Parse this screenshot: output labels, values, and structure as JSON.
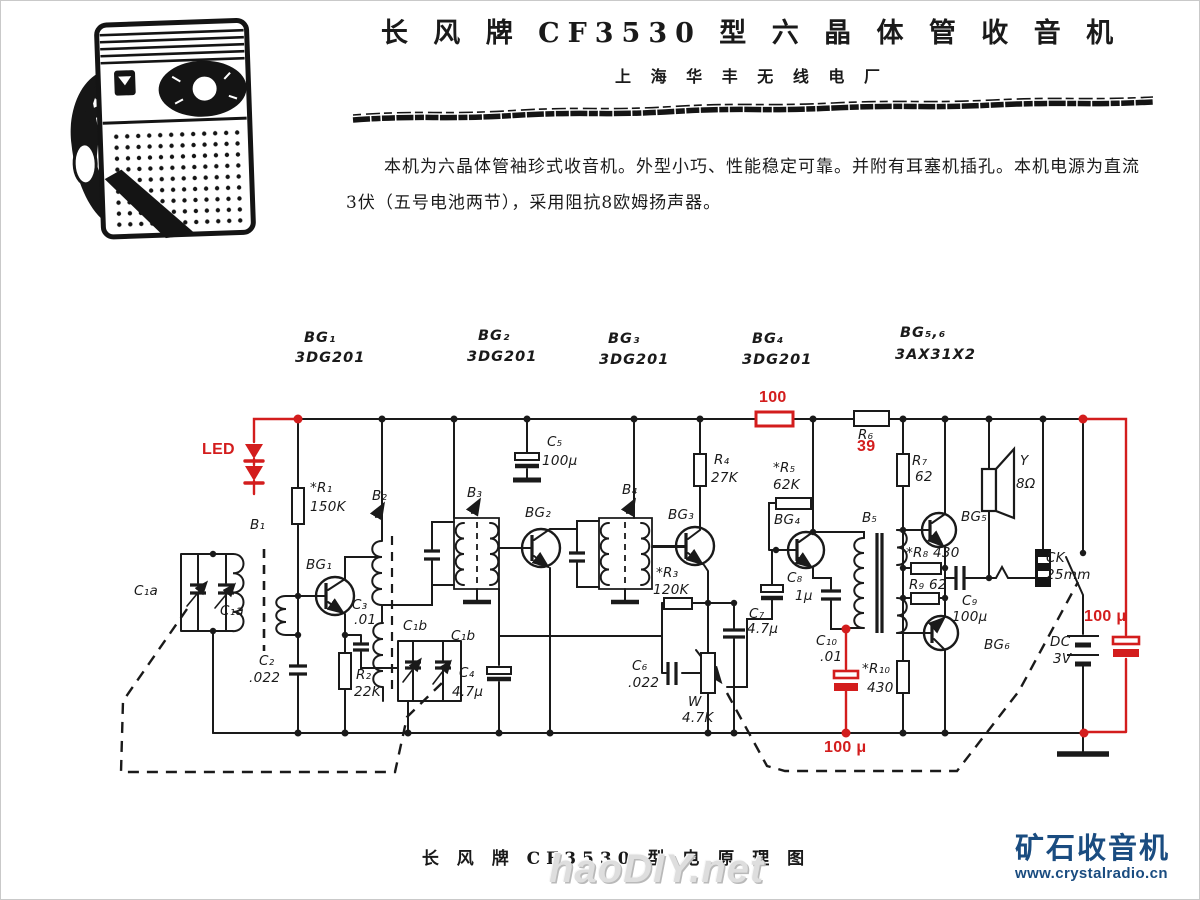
{
  "page": {
    "title": "长 风 牌 CF3530 型 六 晶 体 管 收 音 机",
    "subtitle": "上 海 华 丰 无 线 电 厂",
    "intro_line1": "本机为六晶体管袖珍式收音机。外型小巧、性能稳定可靠。并附有耳塞机插孔。本机电源为直流",
    "intro_line2": "3伏（五号电池两节），采用阻抗8欧姆扬声器。",
    "caption": "长 风 牌 CF3530 型 电 原 理 图"
  },
  "watermarks": {
    "haodiy": "haoDIY.net",
    "crystal_title": "矿石收音机",
    "crystal_url": "www.crystalradio.cn",
    "crystal_color": "#1a4c80"
  },
  "colors": {
    "annotation_red": "#d31d1d",
    "ink": "#1a1a1a"
  },
  "schematic": {
    "transistor_types": [
      "3DG201",
      "3DG201",
      "3DG201",
      "3DG201",
      "3AX31X2"
    ],
    "labels": [
      {
        "n": "bg1-name",
        "t": "BG₁",
        "x": 303,
        "y": 329,
        "c": "hdr"
      },
      {
        "n": "bg1-type",
        "t": "3DG201",
        "x": 294,
        "y": 349,
        "c": "hdr"
      },
      {
        "n": "bg2-name",
        "t": "BG₂",
        "x": 477,
        "y": 327,
        "c": "hdr"
      },
      {
        "n": "bg2-type",
        "t": "3DG201",
        "x": 466,
        "y": 348,
        "c": "hdr"
      },
      {
        "n": "bg3-name",
        "t": "BG₃",
        "x": 607,
        "y": 330,
        "c": "hdr"
      },
      {
        "n": "bg3-type",
        "t": "3DG201",
        "x": 598,
        "y": 351,
        "c": "hdr"
      },
      {
        "n": "bg4-name",
        "t": "BG₄",
        "x": 751,
        "y": 330,
        "c": "hdr"
      },
      {
        "n": "bg4-type",
        "t": "3DG201",
        "x": 741,
        "y": 351,
        "c": "hdr"
      },
      {
        "n": "bg56-name",
        "t": "BG₅,₆",
        "x": 899,
        "y": 324,
        "c": "hdr"
      },
      {
        "n": "bg56-type",
        "t": "3AX31X2",
        "x": 894,
        "y": 346,
        "c": "hdr"
      },
      {
        "n": "b1",
        "t": "B₁",
        "x": 249,
        "y": 516
      },
      {
        "n": "c1a-1",
        "t": "C₁a",
        "x": 133,
        "y": 582
      },
      {
        "n": "c1a-2",
        "t": "C₁a",
        "x": 219,
        "y": 602
      },
      {
        "n": "r1",
        "t": "*R₁",
        "x": 309,
        "y": 479
      },
      {
        "n": "r1-val",
        "t": "150K",
        "x": 309,
        "y": 498
      },
      {
        "n": "bg1",
        "t": "BG₁",
        "x": 305,
        "y": 556
      },
      {
        "n": "b2",
        "t": "B₂",
        "x": 371,
        "y": 487
      },
      {
        "n": "c3",
        "t": "C₃",
        "x": 351,
        "y": 596
      },
      {
        "n": "c3-val",
        "t": ".01",
        "x": 353,
        "y": 611
      },
      {
        "n": "c2",
        "t": "C₂",
        "x": 258,
        "y": 652
      },
      {
        "n": "c2-val",
        "t": ".022",
        "x": 248,
        "y": 669
      },
      {
        "n": "r2",
        "t": "R₂",
        "x": 355,
        "y": 666
      },
      {
        "n": "r2-val",
        "t": "22K",
        "x": 353,
        "y": 683
      },
      {
        "n": "c1b-1",
        "t": "C₁b",
        "x": 402,
        "y": 617
      },
      {
        "n": "c1b-2",
        "t": "C₁b",
        "x": 450,
        "y": 627
      },
      {
        "n": "c4",
        "t": "C₄",
        "x": 458,
        "y": 664
      },
      {
        "n": "c4-val",
        "t": "4.7μ",
        "x": 451,
        "y": 683
      },
      {
        "n": "b3",
        "t": "B₃",
        "x": 466,
        "y": 484
      },
      {
        "n": "bg2",
        "t": "BG₂",
        "x": 524,
        "y": 504
      },
      {
        "n": "c5",
        "t": "C₅",
        "x": 546,
        "y": 433
      },
      {
        "n": "c5-val",
        "t": "100μ",
        "x": 541,
        "y": 452
      },
      {
        "n": "b4",
        "t": "B₄",
        "x": 621,
        "y": 481
      },
      {
        "n": "bg3",
        "t": "BG₃",
        "x": 667,
        "y": 506
      },
      {
        "n": "r4",
        "t": "R₄",
        "x": 713,
        "y": 451
      },
      {
        "n": "r4-val",
        "t": "27K",
        "x": 710,
        "y": 469
      },
      {
        "n": "r3",
        "t": "*R₃",
        "x": 655,
        "y": 564
      },
      {
        "n": "r3-val",
        "t": "120K",
        "x": 652,
        "y": 581
      },
      {
        "n": "c7",
        "t": "C₇",
        "x": 748,
        "y": 605
      },
      {
        "n": "c7-val",
        "t": "4.7μ",
        "x": 746,
        "y": 620
      },
      {
        "n": "c6",
        "t": "C₆",
        "x": 631,
        "y": 657
      },
      {
        "n": "c6-val",
        "t": ".022",
        "x": 627,
        "y": 674
      },
      {
        "n": "w",
        "t": "W",
        "x": 687,
        "y": 693
      },
      {
        "n": "w-val",
        "t": "4.7K",
        "x": 681,
        "y": 709
      },
      {
        "n": "r5",
        "t": "*R₅",
        "x": 772,
        "y": 459
      },
      {
        "n": "r5-val",
        "t": "62K",
        "x": 772,
        "y": 476
      },
      {
        "n": "bg4",
        "t": "BG₄",
        "x": 773,
        "y": 511
      },
      {
        "n": "c8",
        "t": "C₈",
        "x": 786,
        "y": 569
      },
      {
        "n": "c8-val",
        "t": "1μ",
        "x": 794,
        "y": 587
      },
      {
        "n": "c10",
        "t": "C₁₀",
        "x": 815,
        "y": 632
      },
      {
        "n": "c10-val",
        "t": ".01",
        "x": 819,
        "y": 648
      },
      {
        "n": "b5",
        "t": "B₅",
        "x": 861,
        "y": 509
      },
      {
        "n": "r6",
        "t": "R₆",
        "x": 857,
        "y": 426
      },
      {
        "n": "r7",
        "t": "R₇",
        "x": 911,
        "y": 452
      },
      {
        "n": "r7-val",
        "t": "62",
        "x": 914,
        "y": 468
      },
      {
        "n": "r8",
        "t": "*R₈ 430",
        "x": 905,
        "y": 544
      },
      {
        "n": "r9",
        "t": "R₉ 62",
        "x": 908,
        "y": 576
      },
      {
        "n": "r10",
        "t": "*R₁₀",
        "x": 861,
        "y": 660
      },
      {
        "n": "r10-val",
        "t": "430",
        "x": 866,
        "y": 679
      },
      {
        "n": "bg5",
        "t": "BG₅",
        "x": 960,
        "y": 508
      },
      {
        "n": "bg6",
        "t": "BG₆",
        "x": 983,
        "y": 636
      },
      {
        "n": "c9",
        "t": "C₉",
        "x": 961,
        "y": 592
      },
      {
        "n": "c9-val",
        "t": "100μ",
        "x": 951,
        "y": 608
      },
      {
        "n": "y",
        "t": "Y",
        "x": 1019,
        "y": 452
      },
      {
        "n": "y-val",
        "t": "8Ω",
        "x": 1015,
        "y": 475
      },
      {
        "n": "ck",
        "t": "CK",
        "x": 1045,
        "y": 549
      },
      {
        "n": "ck-val",
        "t": "25mm",
        "x": 1045,
        "y": 566
      },
      {
        "n": "dc",
        "t": "DC",
        "x": 1049,
        "y": 633
      },
      {
        "n": "dc-val",
        "t": "3V",
        "x": 1052,
        "y": 650
      },
      {
        "n": "led",
        "t": "LED",
        "x": 201,
        "y": 440,
        "c": "red"
      },
      {
        "n": "r-100",
        "t": "100",
        "x": 758,
        "y": 388,
        "c": "red"
      },
      {
        "n": "r6-39",
        "t": "39",
        "x": 856,
        "y": 437,
        "c": "red"
      },
      {
        "n": "cap-100u-bottom",
        "t": "100 μ",
        "x": 823,
        "y": 738,
        "c": "red"
      },
      {
        "n": "cap-100u-right",
        "t": "100 μ",
        "x": 1083,
        "y": 607,
        "c": "red"
      }
    ]
  }
}
